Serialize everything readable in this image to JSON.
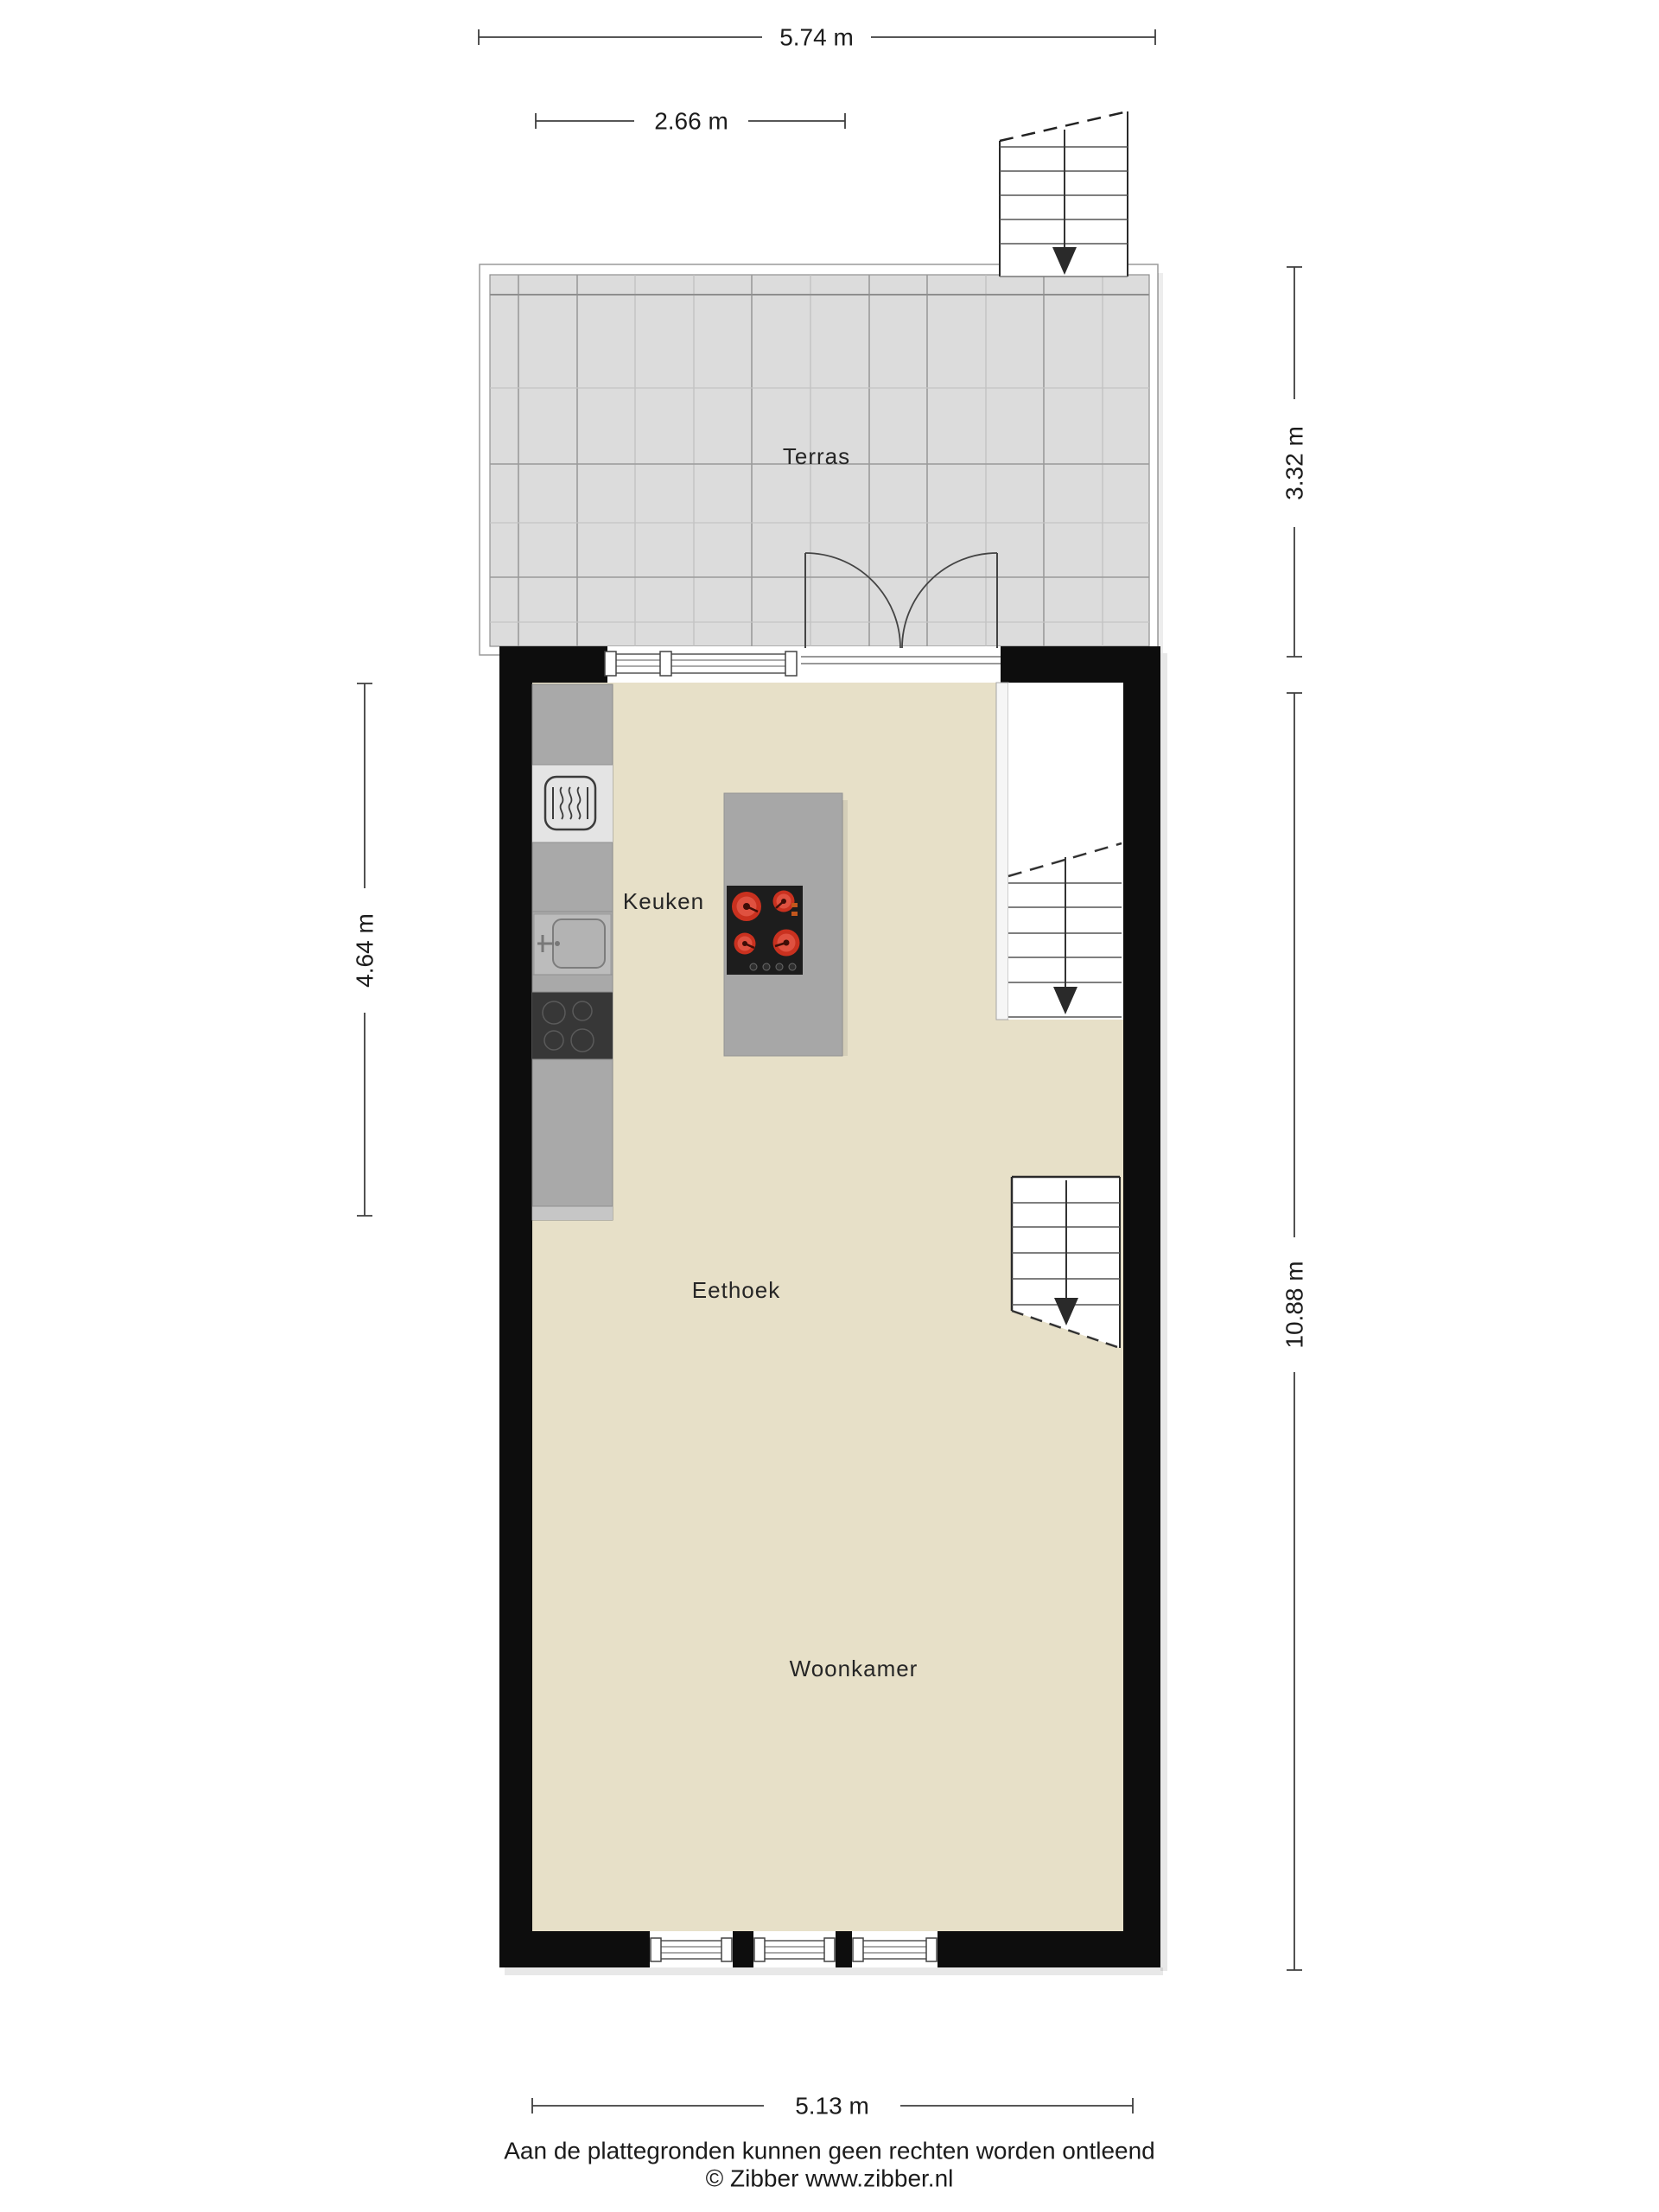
{
  "rooms": {
    "terras": "Terras",
    "keuken": "Keuken",
    "eethoek": "Eethoek",
    "woonkamer": "Woonkamer"
  },
  "dimensions": {
    "top": "5.74 m",
    "top_inner": "2.66 m",
    "left": "4.64 m",
    "right_top": "3.32 m",
    "right_bottom": "10.88 m",
    "bottom": "5.13 m"
  },
  "footer": {
    "disclaimer": "Aan de plattegronden kunnen geen rechten worden ontleend",
    "copyright": "© Zibber www.zibber.nl"
  },
  "colors": {
    "wall": "#0d0d0d",
    "floor": "#e7e0c8",
    "tile": "#dcdcdc",
    "counter": "#a9a9a9",
    "island": "#a7a7a7",
    "island_cooktop": "#1d1d1d",
    "counter_cooktop": "#373737",
    "burner_red": "#c9311f",
    "burner_inner": "#df5140"
  },
  "icons": {
    "stairs_down_arrow": "▼",
    "oven": "heat-waves",
    "sink": "basin",
    "cooktop": "burner-circles"
  }
}
